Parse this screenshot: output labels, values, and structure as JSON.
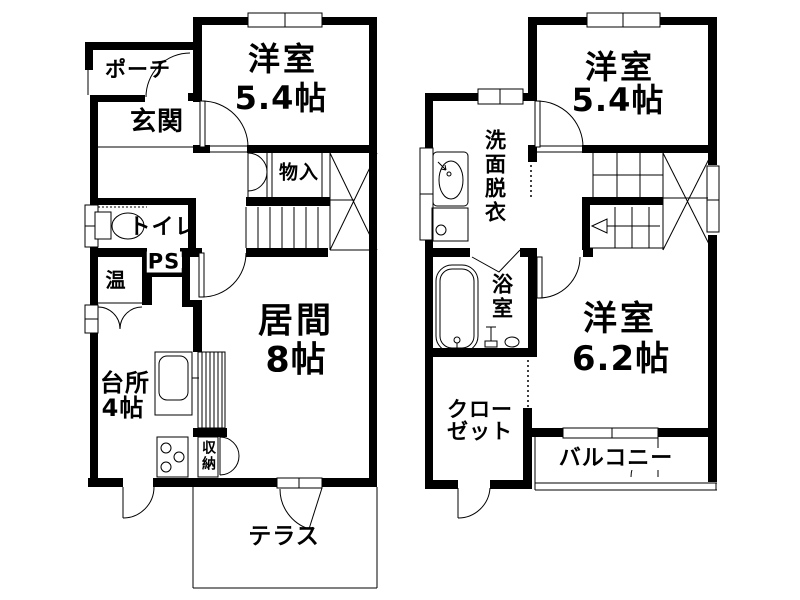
{
  "floor1": {
    "rooms": {
      "porch": {
        "label": "ポーチ"
      },
      "entrance": {
        "label": "玄関"
      },
      "western_room": {
        "label": "洋室",
        "size": "5.4帖"
      },
      "storage_mono": {
        "label": "物入"
      },
      "toilet": {
        "label": "トイレ"
      },
      "pipe_space": {
        "label": "PS"
      },
      "water_heater": {
        "label": "温"
      },
      "living": {
        "label": "居間",
        "size": "8帖"
      },
      "kitchen": {
        "label": "台所",
        "size": "4帖"
      },
      "storage_shuno": {
        "label": "収納"
      },
      "terrace": {
        "label": "テラス"
      }
    }
  },
  "floor2": {
    "rooms": {
      "western_room_a": {
        "label": "洋室",
        "size": "5.4帖"
      },
      "washroom": {
        "label": "洗面脱衣"
      },
      "bathroom": {
        "label": "浴室"
      },
      "western_room_b": {
        "label": "洋室",
        "size": "6.2帖"
      },
      "closet": {
        "line1": "クロー",
        "line2": "ゼット"
      },
      "balcony": {
        "label": "バルコニー"
      }
    }
  },
  "colors": {
    "wall": "#000000",
    "line": "#000000",
    "background": "#ffffff",
    "text": "#000000"
  }
}
